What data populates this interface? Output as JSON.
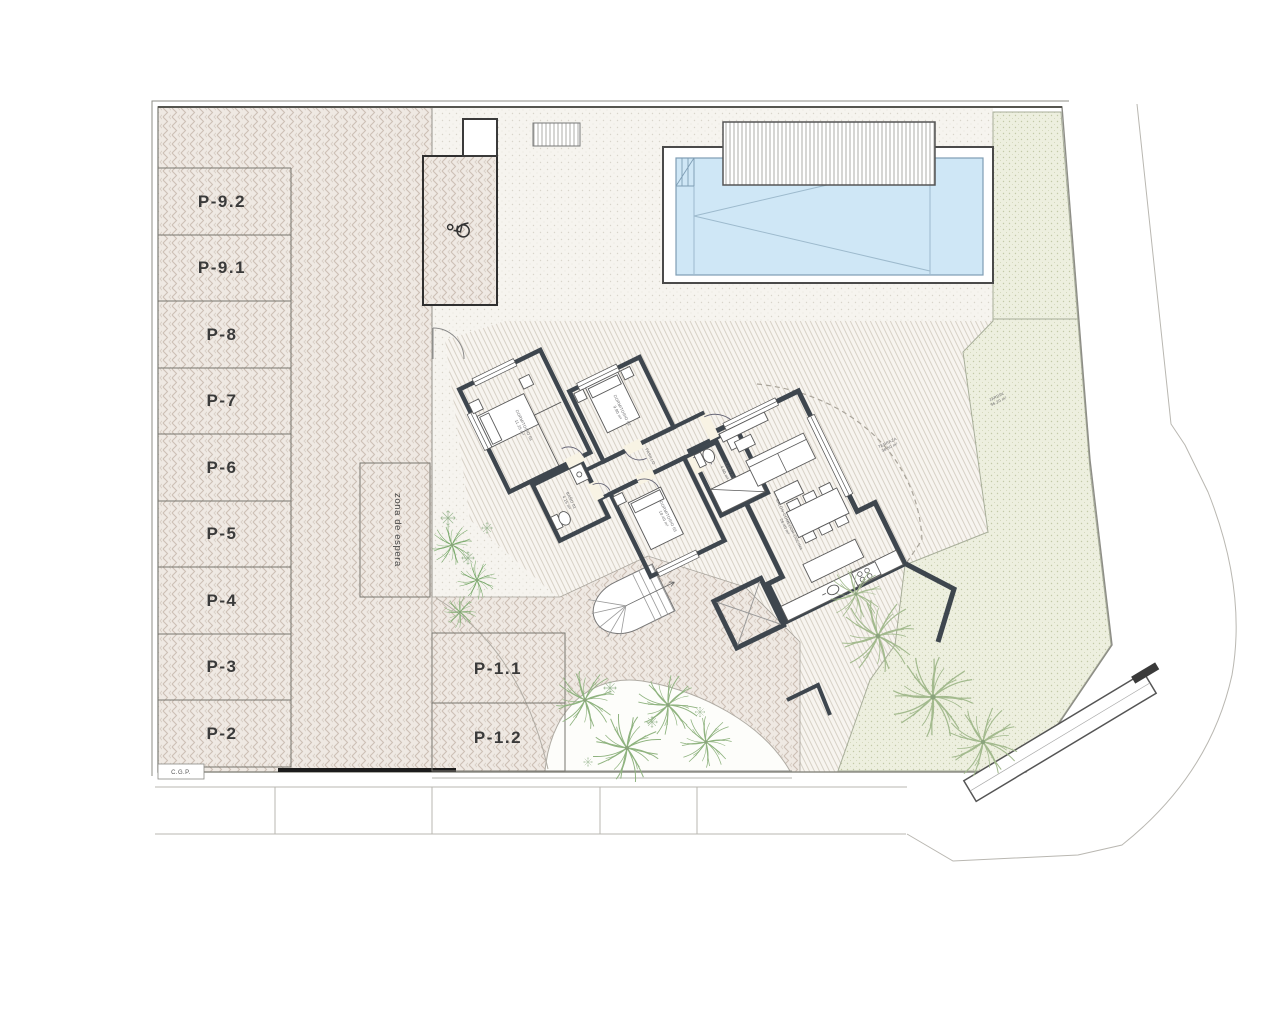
{
  "plan": {
    "parking": {
      "left": [
        "P-9.2",
        "P-9.1",
        "P-8",
        "P-7",
        "P-6",
        "P-5",
        "P-4",
        "P-3",
        "P-2"
      ],
      "bottom": [
        "P-1.1",
        "P-1.2"
      ],
      "waiting_zone": "zona de espera"
    },
    "rooms": {
      "bedroom1": {
        "name": "DORMITORIO 01",
        "area": "11.25 m²"
      },
      "bedroom2": {
        "name": "DORMITORIO 02",
        "area": "9.80 m²"
      },
      "bedroom3": {
        "name": "DORMITORIO 03",
        "area": "10.40 m²"
      },
      "bath1": {
        "name": "BAÑO 01",
        "area": "4.15 m²"
      },
      "bath2": {
        "name": "BAÑO 02",
        "area": "4.60 m²"
      },
      "hall": {
        "name": "PASILLO",
        "area": "6.10 m²"
      },
      "living": {
        "name": "SALÓN-COMEDOR-COCINA",
        "area": "26.40 m²"
      },
      "terrace": {
        "name": "TERRAZA",
        "area": "38.50 m²"
      },
      "garden": {
        "name": "JARDÍN",
        "area": "96.20 m²"
      }
    },
    "annotations": {
      "cgp": "C.G.P."
    },
    "colors": {
      "bedroom": "#d9e7d4",
      "bathroom": "#ccdcec",
      "living": "#f8f3e4",
      "pool": "#cfe7f6",
      "paving": "#efe9e3",
      "garden": "#edefdf"
    }
  }
}
